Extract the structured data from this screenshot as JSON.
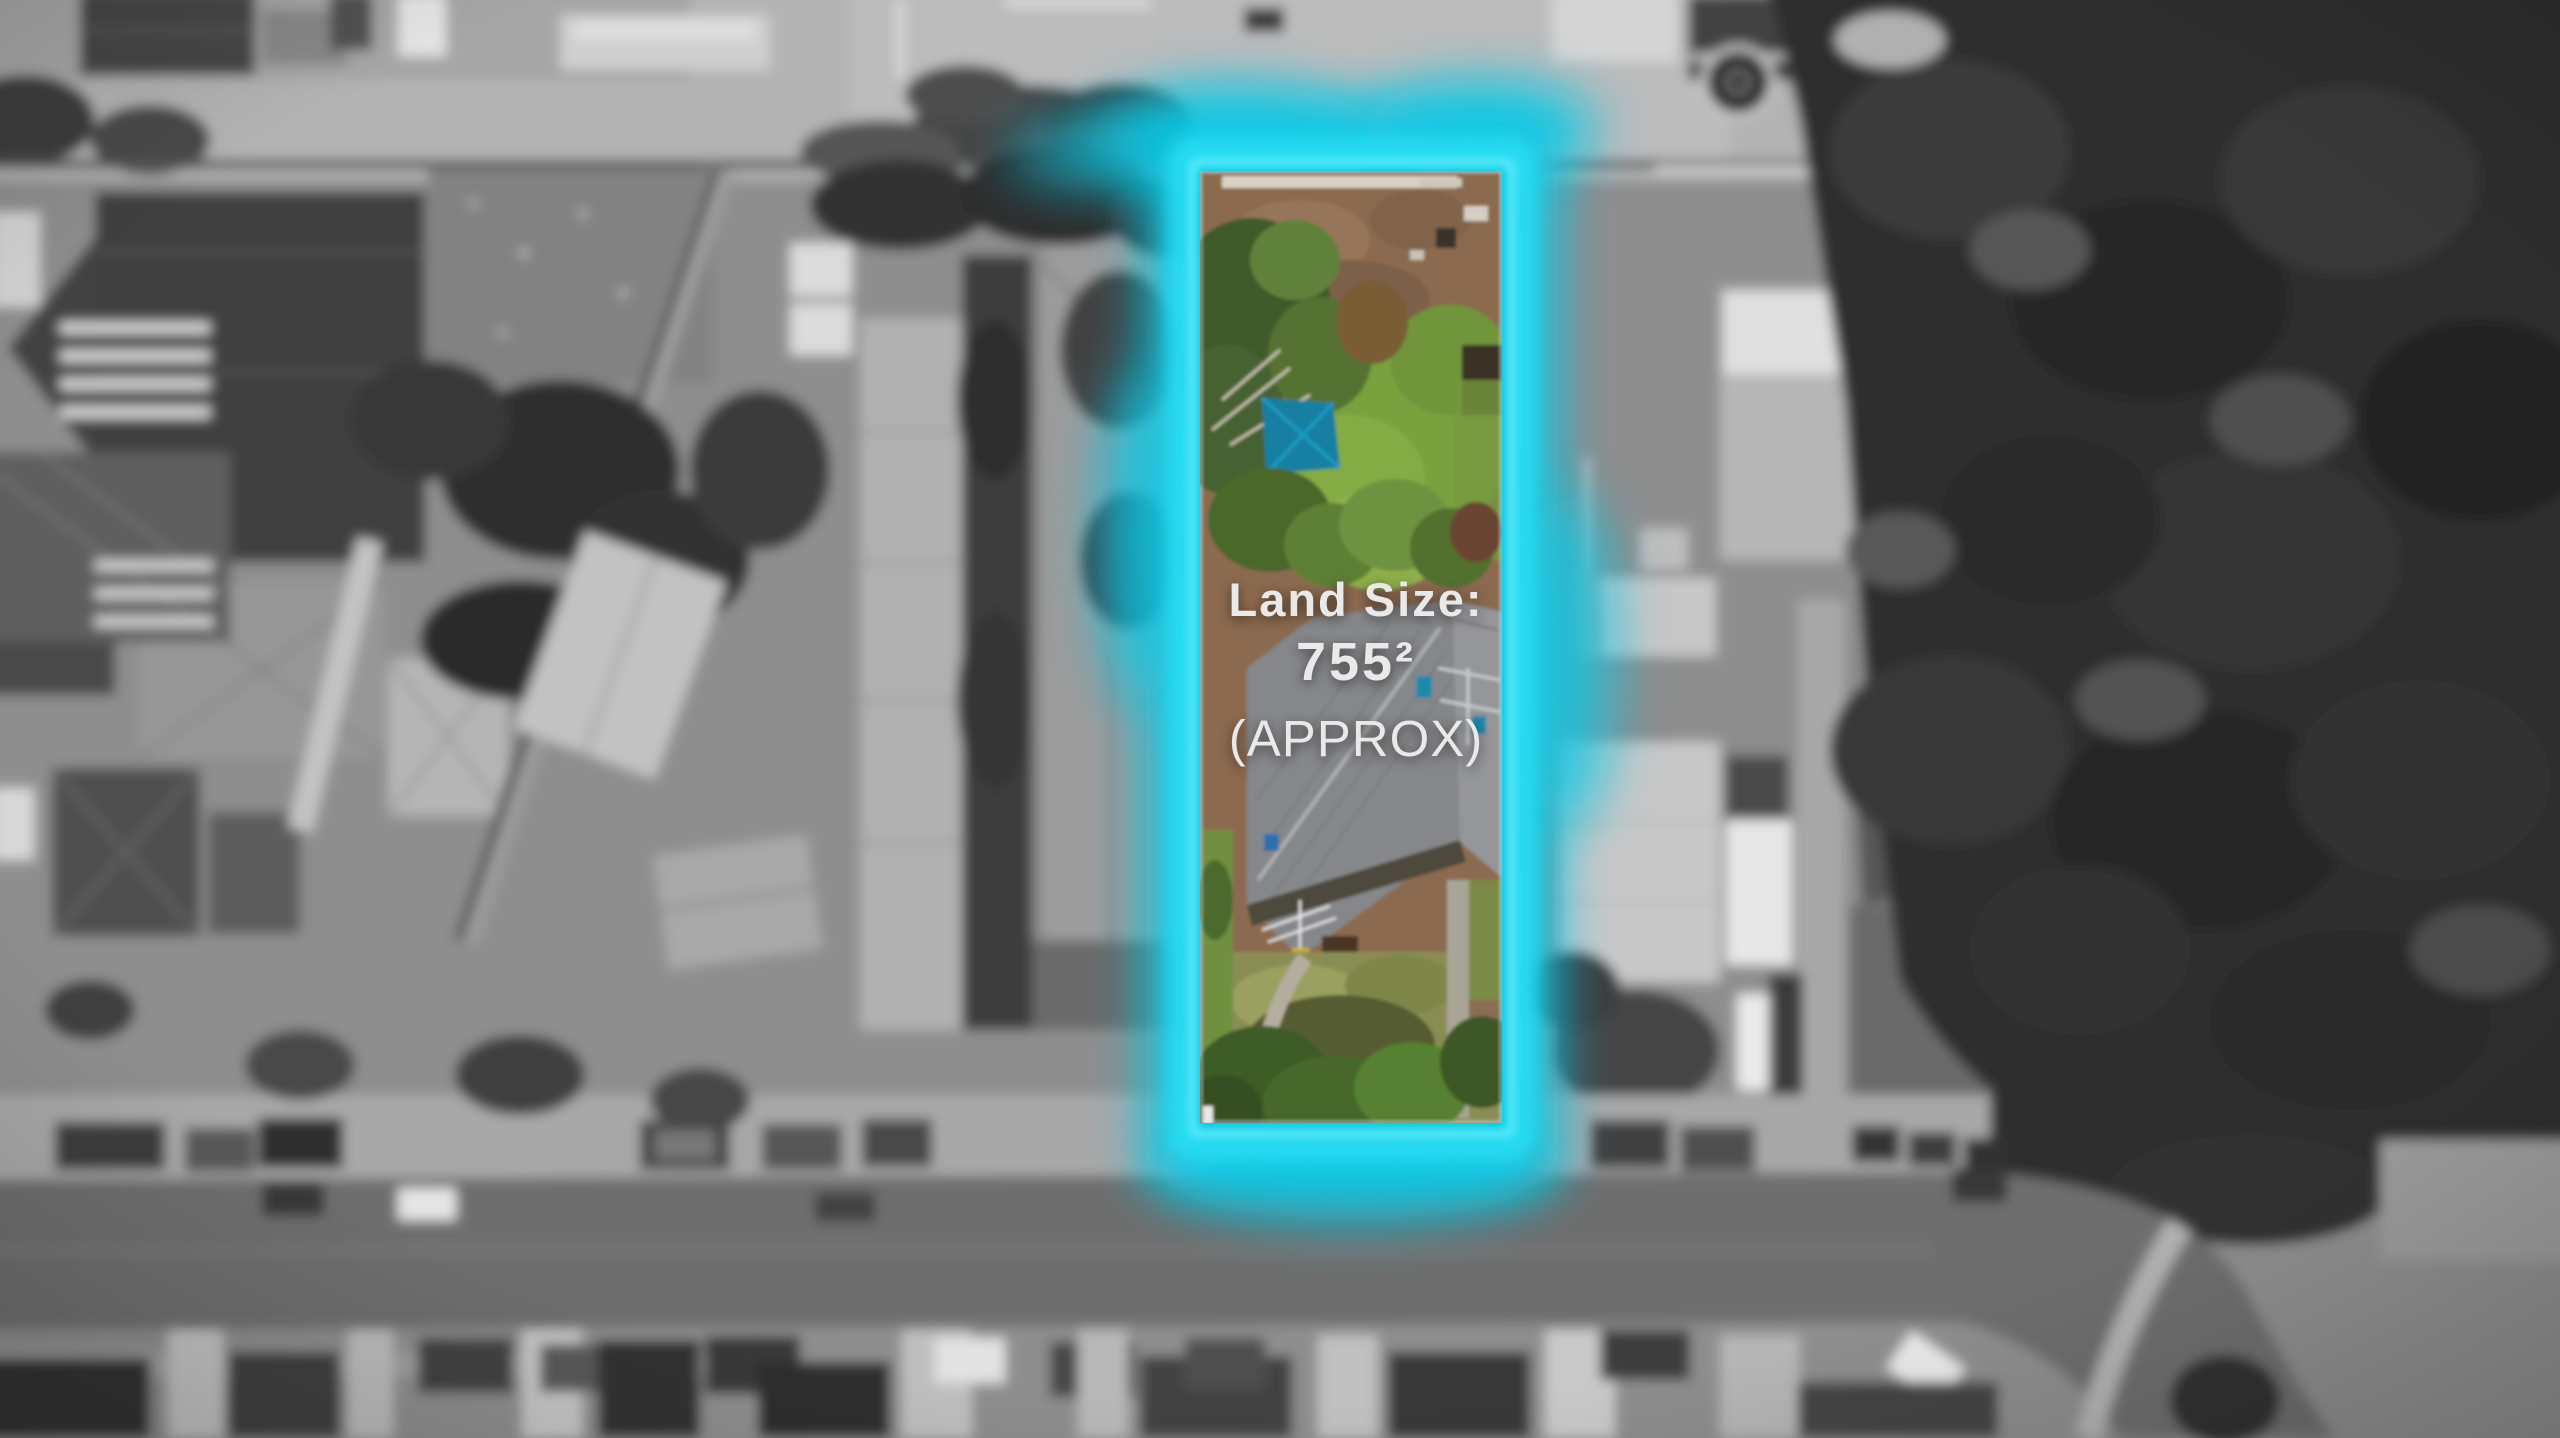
{
  "annotation": {
    "land_size_label": "Land Size:",
    "land_size_value": "755²",
    "approx_label": "(APPROX)"
  },
  "colors": {
    "text_color": "#e9e9e9",
    "highlight_cyan": "#0bc8e4",
    "highlight_cyan_bright": "#2adef4",
    "highlight_cyan_inner": "#56ebfb",
    "tarp_teal": "#137fa2",
    "lawn_green": "#79a13e",
    "dirt_brown": "#8c6b50",
    "roof_gray": "#85878a"
  }
}
